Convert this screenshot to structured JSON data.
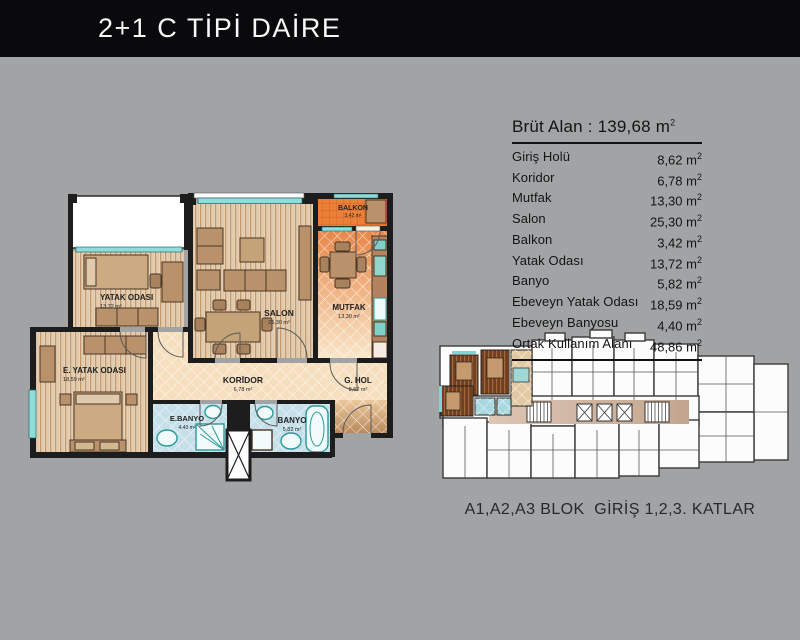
{
  "title": "2+1 C TİPİ DAİRE",
  "colors": {
    "background": "#a1a3a5",
    "banner": "#0a0a0c",
    "wall": "#1d1d1e",
    "window_cyan": "#8fdcdc",
    "wood_floor": "#e7d3b9",
    "kitchen_orange": "#e8874a",
    "balcony_orange": "#ec8038",
    "corridor_peach": "#f6dfbf",
    "bathroom_blue": "#c6e0ea",
    "furniture_brown": "#b9926b",
    "site_highlight_wood": "#6f3f22",
    "site_corridor": "#d3b9a5"
  },
  "area_table": {
    "header_label": "Brüt Alan :",
    "header_value": "139,68",
    "unit": "m",
    "sup": "2",
    "rows": [
      {
        "label": "Giriş Holü",
        "value": "8,62"
      },
      {
        "label": "Koridor",
        "value": "6,78"
      },
      {
        "label": "Mutfak",
        "value": "13,30"
      },
      {
        "label": "Salon",
        "value": "25,30"
      },
      {
        "label": "Balkon",
        "value": "3,42"
      },
      {
        "label": "Yatak Odası",
        "value": "13,72"
      },
      {
        "label": "Banyo",
        "value": "5,82"
      },
      {
        "label": "Ebeveyn Yatak Odası",
        "value": "18,59"
      },
      {
        "label": "Ebeveyn Banyosu",
        "value": "4,40"
      },
      {
        "label": "Ortak Kullanım Alanı",
        "value": "48,86"
      }
    ]
  },
  "floor_plan": {
    "rooms": [
      {
        "name": "YATAK ODASI",
        "area": "13,72 m²"
      },
      {
        "name": "SALON",
        "area": "25,30 m²"
      },
      {
        "name": "MUTFAK",
        "area": "13,30 m²"
      },
      {
        "name": "BALKON",
        "area": "3,42 m²"
      },
      {
        "name": "E. YATAK ODASI",
        "area": "18,59 m²"
      },
      {
        "name": "KORİDOR",
        "area": "6,78 m²"
      },
      {
        "name": "G. HOL",
        "area": "8,62 m²"
      },
      {
        "name": "E.BANYO",
        "area": "4,40 m²"
      },
      {
        "name": "BANYO",
        "area": "5,82 m²"
      }
    ]
  },
  "site_plan": {
    "caption": "A1,A2,A3 BLOK  GİRİŞ 1,2,3. KATLAR"
  }
}
